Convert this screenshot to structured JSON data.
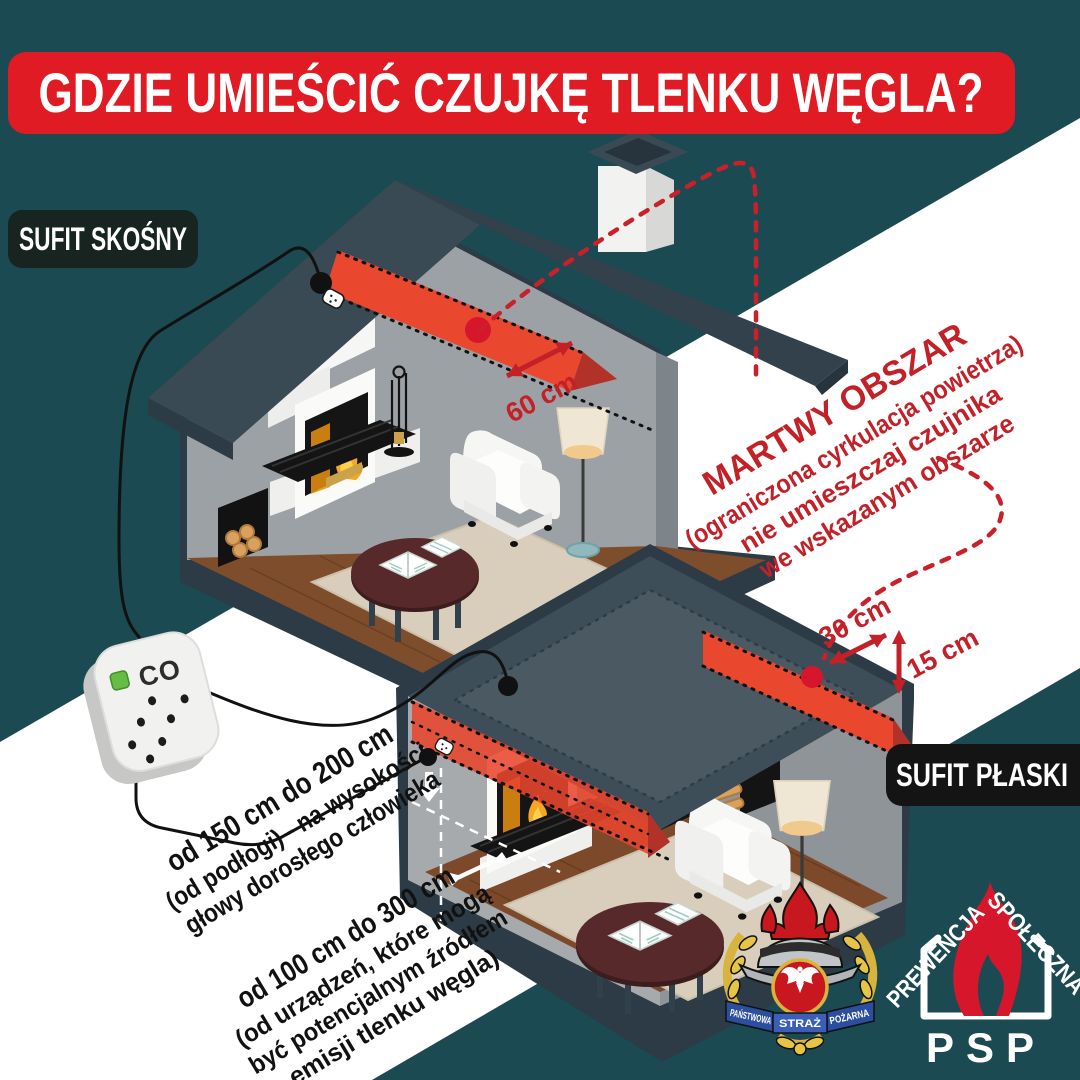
{
  "title": "GDZIE UMIEŚCIĆ CZUJKĘ TLENKU WĘGLA?",
  "ceiling_labels": {
    "sloped": "SUFIT SKOŚNY",
    "flat": "SUFIT PŁASKI"
  },
  "dead_zone_note": {
    "heading": "MARTWY OBSZAR",
    "line1": "(ograniczona cyrkulacja powietrza)",
    "line2": "nie umieszczaj czujnika",
    "line3": "we wskazanym obszarze"
  },
  "measurements": {
    "sloped_ceiling_offset": "60 cm",
    "flat_ceiling_offset": "30 cm",
    "wall_top_offset": "15 cm"
  },
  "mounting_height_note": {
    "line1": "od 150 cm do 200 cm",
    "line2": "(od podłogi) - na wysokości",
    "line3": "głowy dorosłego człowieka"
  },
  "distance_note": {
    "line1": "od 100 cm do 300 cm",
    "line2": "(od urządzeń, które mogą",
    "line3": "być potencjalnym źródłem",
    "line4": "emisji tlenku węgla)"
  },
  "co_detector_label": "CO",
  "logos": {
    "fire_service_crest": {
      "ribbon_left": "PAŃSTWOWA",
      "ribbon_center": "STRAŻ",
      "ribbon_right": "POŻARNA"
    },
    "prevention": {
      "word_top_left": "PREWENCJA",
      "word_top_right": "SPOŁECZNA",
      "abbreviation": "PSP"
    }
  },
  "colors": {
    "background_teal": "#1b4a52",
    "banner_red": "#e01b24",
    "dead_zone_red": "#e9472e",
    "marker_red": "#d6172b",
    "annotation_red": "#c32028",
    "roof_slate": "#37464f",
    "label_box_dark": "#18241f"
  }
}
